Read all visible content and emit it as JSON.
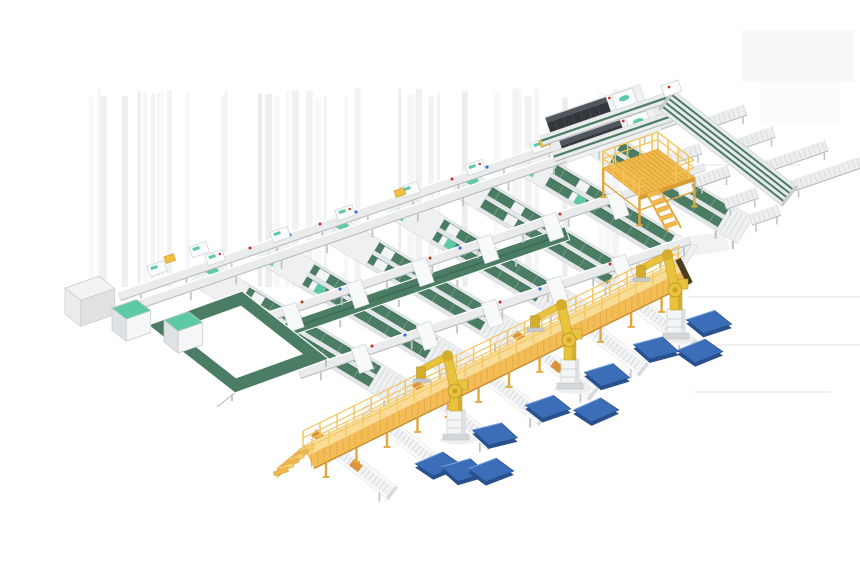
{
  "meta": {
    "kind": "isometric-3d-illustration",
    "subject": "automated-conveyor-sorting-line-with-palletizing-robots",
    "visible_text": "none"
  },
  "colors": {
    "background": "#ffffff",
    "stripe": "#dcdcdc",
    "floor_shadow": "#e0e0e0",
    "frame_light": "#e3e6e8",
    "rail_body": "#e9ebec",
    "rail_edge_dark": "#b4b7ba",
    "rail_stroke": "#cbd0d3",
    "leg_gray": "#c2c5c7",
    "belt_green": "#4a7d63",
    "belt_green_dark": "#3c6a53",
    "mint": "#5ec9a5",
    "approach_white": "#eef0f2",
    "divert_white": "#f7f9fa",
    "shuttle_white": "#fbfcfd",
    "cabinet_top": "#f2f3f4",
    "cabinet_front": "#dfe1e3",
    "cabinet_side": "#eaecee",
    "machine_dark": "#33373b",
    "machine_top": "#51565c",
    "machine_base": "#eff1f2",
    "walk_deck": "#f9dd96",
    "walk_side": "#f3bc55",
    "walk_slat": "#e3a94f",
    "walk_rail": "#f3c459",
    "walk_support": "#e0a73c",
    "walk_end_dark": "#4a3d22",
    "mezz_floor": "#f2ba4c",
    "mezz_slat": "#dba23a",
    "mezz_leg": "#e0a73c",
    "robot_yellow": "#e9c33d",
    "robot_shade": "#d4ad2e",
    "robot_joint": "#b79527",
    "pallet_top": "#3b6db8",
    "pallet_side": "#29508f",
    "pallet_stroke": "#24477e",
    "pallet_hi": "#7aa3dc",
    "orange_item": "#da9440",
    "yellow_box": "#f0c040",
    "red_dot": "#c23527",
    "blue_dot": "#3b6fd4"
  },
  "geometry": {
    "angles": {
      "rail": -19,
      "lane": 31,
      "spur": 38,
      "walk": -26.2
    },
    "stripes": {
      "x0": 62,
      "x1": 648,
      "top": 88,
      "bottom": 287,
      "seed": 7
    },
    "rail1": {
      "x": 118,
      "y": 292,
      "len": 585,
      "pair_offset": 14
    },
    "rail2": {
      "x": 228,
      "y": 326,
      "len": 502
    },
    "rail3": {
      "x": 298,
      "y": 370,
      "len": 412
    },
    "lanes": [
      {
        "x": 212,
        "y": 262,
        "len": 244
      },
      {
        "x": 277,
        "y": 239,
        "len": 234
      },
      {
        "x": 342,
        "y": 217,
        "len": 222
      },
      {
        "x": 407,
        "y": 194,
        "len": 211
      },
      {
        "x": 472,
        "y": 172,
        "len": 199
      },
      {
        "x": 537,
        "y": 150,
        "len": 187
      },
      {
        "x": 602,
        "y": 127,
        "len": 176
      }
    ],
    "extra_shuttles": [
      [
        200,
        252
      ],
      [
        158,
        271
      ]
    ],
    "yellow_boxes": [
      [
        170,
        259
      ],
      [
        400,
        193
      ],
      [
        545,
        143
      ]
    ],
    "red_dots": [
      [
        250,
        248
      ],
      [
        320,
        224
      ],
      [
        452,
        179
      ],
      [
        585,
        133
      ],
      [
        302,
        302
      ],
      [
        430,
        258
      ],
      [
        560,
        214
      ],
      [
        372,
        346
      ],
      [
        500,
        302
      ],
      [
        610,
        264
      ]
    ],
    "blue_dots": [
      [
        290,
        235
      ],
      [
        356,
        212
      ],
      [
        487,
        167
      ],
      [
        340,
        289
      ],
      [
        460,
        248
      ],
      [
        405,
        335
      ],
      [
        540,
        289
      ]
    ],
    "collector": {
      "x": 253,
      "y": 334,
      "len": 330,
      "th": 14
    },
    "cabinet": {
      "x": 65,
      "y": 288,
      "w": 36,
      "d": 20,
      "h": 26
    },
    "teal_boxes": [
      [
        112,
        308
      ],
      [
        164,
        320
      ]
    ],
    "loop": {
      "outer": [
        [
          148,
          325
        ],
        [
          242,
          291
        ],
        [
          329,
          359
        ],
        [
          235,
          393
        ]
      ],
      "inset": 0.3
    },
    "machines": [
      [
        545,
        117
      ],
      [
        559,
        140
      ]
    ],
    "feed_rails": [
      {
        "x": 540,
        "y": 136,
        "len": 132
      },
      {
        "x": 552,
        "y": 152,
        "len": 128
      }
    ],
    "topright": {
      "x": 673,
      "y": 90,
      "len": 158,
      "th": 24,
      "trays_left": [
        {
          "t": 52,
          "len": 34
        },
        {
          "t": 88,
          "len": 34
        },
        {
          "t": 124,
          "len": 34
        },
        {
          "t": 152,
          "len": 30
        }
      ],
      "trays_right": [
        {
          "t": 44,
          "len": 36
        },
        {
          "t": 80,
          "len": 36
        },
        {
          "t": 116,
          "len": 62
        },
        {
          "t": 148,
          "len": 74
        }
      ]
    },
    "mezzanine": {
      "tl": [
        603,
        168
      ],
      "alen": 58,
      "blen": 46,
      "leg_h": 28
    },
    "walkway": {
      "x": 303,
      "y": 446,
      "len": 420,
      "deck_th": 11,
      "side_th": 14
    },
    "spurs": {
      "ts": [
        28,
        84,
        140,
        196,
        252,
        308,
        362
      ],
      "len": 100,
      "th": 15,
      "items_on": [
        0,
        2,
        4
      ]
    },
    "robots": [
      [
        456,
        437
      ],
      [
        570,
        386
      ],
      [
        676,
        336
      ]
    ],
    "pallets": [
      [
        438,
        464
      ],
      [
        464,
        470
      ],
      [
        491,
        470
      ],
      [
        495,
        434
      ],
      [
        548,
        407
      ],
      [
        596,
        410
      ],
      [
        607,
        375
      ],
      [
        656,
        348
      ],
      [
        700,
        351
      ],
      [
        709,
        322
      ]
    ],
    "pallet_jitter": [
      -4,
      3,
      -2,
      5,
      0,
      -5,
      2,
      4,
      -3,
      1
    ],
    "shadow_lines": [
      [
        688,
        297,
        860
      ],
      [
        712,
        345,
        860
      ],
      [
        695,
        392,
        830
      ],
      [
        690,
        165,
        800
      ]
    ],
    "shadow_patch": [
      [
        676,
        238
      ],
      [
        724,
        232
      ],
      [
        730,
        250
      ],
      [
        682,
        258
      ]
    ],
    "smear_rects": [
      {
        "x": 742,
        "y": 30,
        "w": 112,
        "h": 52,
        "op": 0.45
      },
      {
        "x": 760,
        "y": 82,
        "w": 80,
        "h": 40,
        "op": 0.25
      }
    ]
  }
}
